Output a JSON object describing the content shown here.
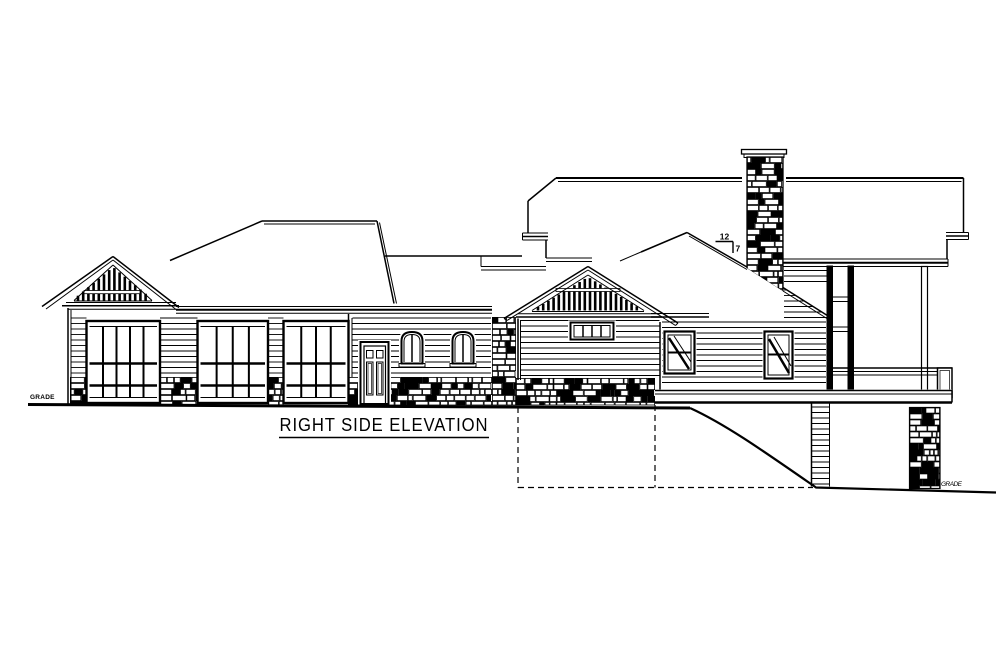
{
  "sheet": {
    "title": "RIGHT SIDE ELEVATION",
    "grade_label_left": "GRADE",
    "grade_label_right": "GRADE",
    "roof_pitch": {
      "run": "12",
      "rise": "7"
    }
  },
  "colors": {
    "ink": "#000000",
    "paper": "#ffffff"
  }
}
